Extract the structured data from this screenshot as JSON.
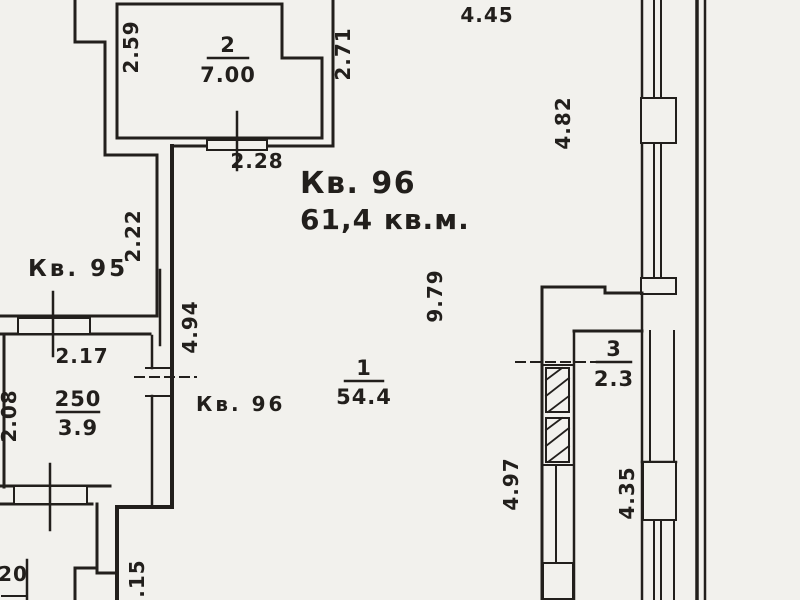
{
  "title": {
    "apartment": "Кв. 96",
    "area": "61,4 кв.м."
  },
  "neighbor": {
    "label": "Кв. 95"
  },
  "pointer_label": {
    "kv96": "Кв. 96"
  },
  "rooms": {
    "room1": {
      "number": "1",
      "area": "54.4"
    },
    "room2": {
      "number": "2",
      "area": "7.00"
    },
    "room3": {
      "number": "3",
      "area": "2.3"
    },
    "room_small": {
      "value_top": "250",
      "value_bottom": "3.9"
    }
  },
  "dimensions": {
    "d2_59": "2.59",
    "d2_71": "2.71",
    "d4_45": "4.45",
    "d2_28": "2.28",
    "d2_22": "2.22",
    "d2_17": "2.17",
    "d4_94": "4.94",
    "d4_82": "4.82",
    "d9_79": "9.79",
    "d2_08": "2.08",
    "d4_97": "4.97",
    "d4_35": "4.35",
    "d2_15": "2.15",
    "d20": "20"
  },
  "colors": {
    "ink": "#221f1c",
    "accent_red": "#571212",
    "label_gray": "#3d3733",
    "paper": "#f2f1ed"
  }
}
